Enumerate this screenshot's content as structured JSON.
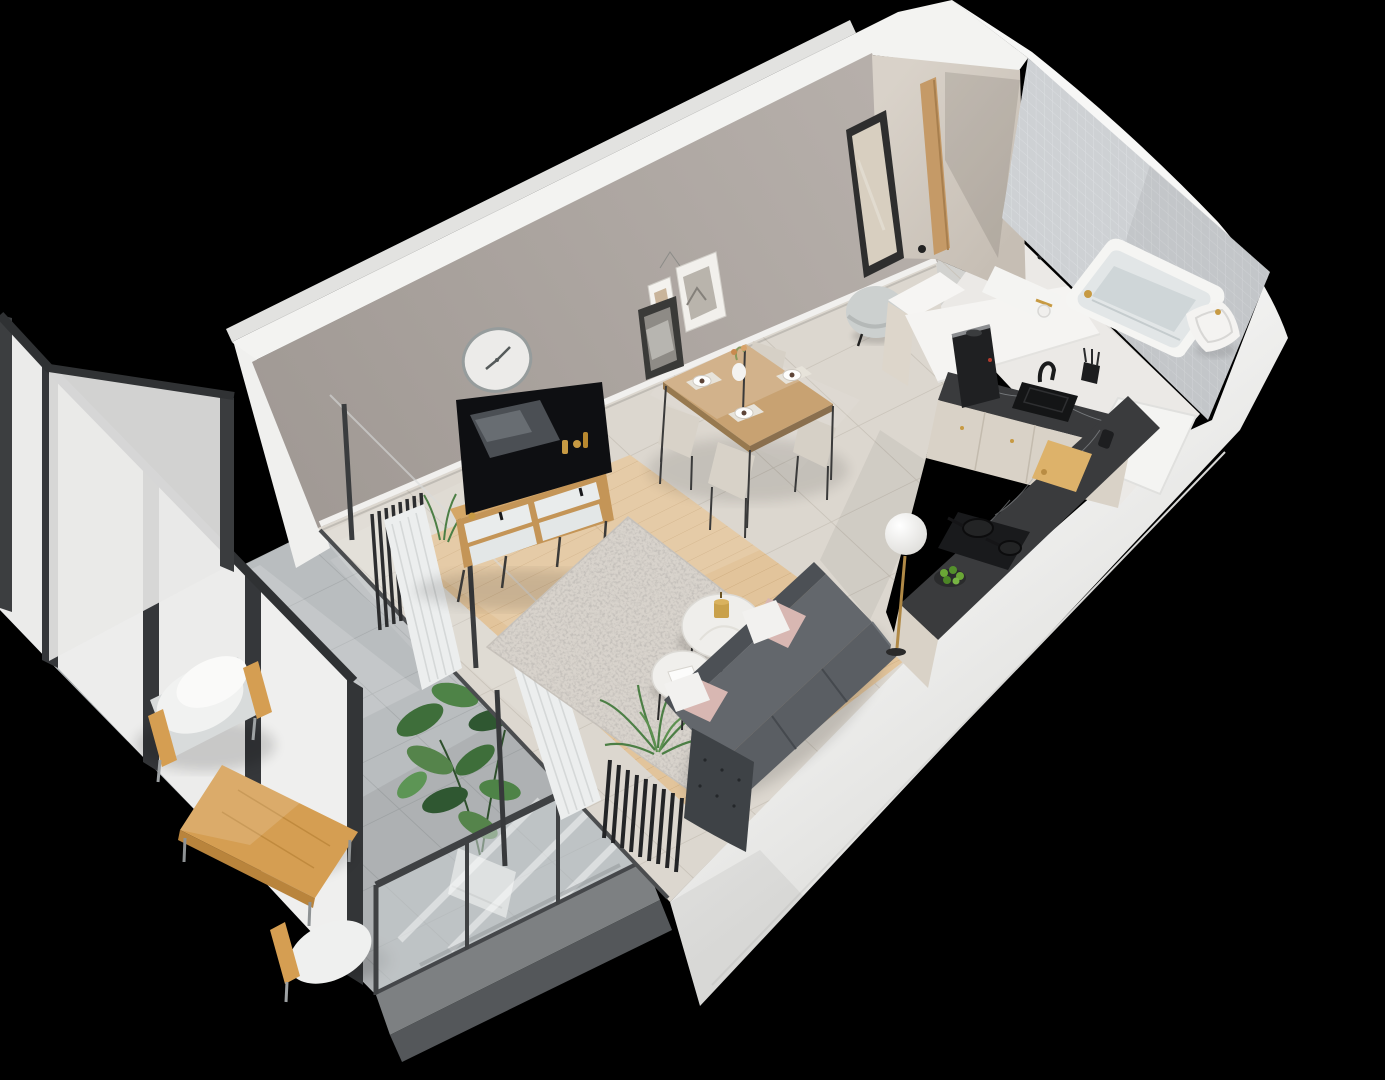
{
  "meta": {
    "title": "3D isometric cutaway render of a studio apartment with balcony",
    "render_style": "axonometric dollhouse view, no visible text"
  },
  "palette": {
    "background": "#000000",
    "wall_cut": "#f3f3f1",
    "wall_outer": "#e9e9e8",
    "wall_face": "#aba49f",
    "hall_wall": "#d5cec5",
    "tile_floor": "#dcd7cf",
    "hall_floor": "#d2d2cf",
    "wood_floor": "#e2c49b",
    "rug": "#d8d3cc",
    "balcony_floor": "#b9bdbf",
    "bath_tile": "#ced1d4",
    "bath_floor": "#ebe9e6",
    "countertop_marble": "#3a3b3d",
    "cabinet": "#d9d2c7",
    "sofa": "#5a5e63",
    "sofa_chaise": "#3e4246",
    "pillow_pink": "#d8b7b2",
    "pillow_white": "#f2f1ef",
    "curtain": "#eceeee",
    "frosted_glass": "#ededec",
    "glazing_frame": "#35373a",
    "sideboard_wood": "#c49557",
    "dining_wood": "#c8a272",
    "outdoor_wood": "#d59e52",
    "gold_accent": "#c79a43",
    "plant_green": "#4c7f45",
    "fixture_white": "#f5f5f3"
  },
  "scene": {
    "view": "isometric-cutaway-3d-floorplan",
    "rooms": [
      {
        "name": "living-room",
        "items": [
          "tv",
          "tv-sideboard",
          "wall-clock",
          "gallery-frames",
          "shag-rug",
          "gray-sofa",
          "pink-pillows",
          "white-pillows",
          "coffee-table-large",
          "coffee-table-small",
          "fern-plant",
          "column-radiator",
          "floor-lamp",
          "sheer-curtains"
        ]
      },
      {
        "name": "dining-area",
        "items": [
          "wood-dining-table",
          "cream-chairs-x4",
          "vase-with-flowers",
          "place-settings"
        ]
      },
      {
        "name": "kitchen",
        "items": [
          "l-shaped-counter",
          "dark-marble-countertop",
          "cream-cabinets",
          "coffee-machine",
          "black-sink",
          "faucet",
          "cooktop",
          "frying-pans",
          "cutting-board",
          "fruit-bowl-limes",
          "cookbook-shelf",
          "hanging-utensils"
        ]
      },
      {
        "name": "bathroom",
        "items": [
          "bathtub",
          "toilet",
          "toilet-paper-holder",
          "tiled-wall",
          "shower-tray",
          "gold-fittings"
        ]
      },
      {
        "name": "entry-hall",
        "items": [
          "leaning-mirror",
          "gray-pouf",
          "wood-door-frame"
        ]
      },
      {
        "name": "balcony",
        "items": [
          "outdoor-armchair-x2",
          "outdoor-wood-table",
          "potted-fig-plant",
          "glass-railing",
          "frosted-glazing",
          "concrete-tile-floor"
        ]
      }
    ]
  }
}
